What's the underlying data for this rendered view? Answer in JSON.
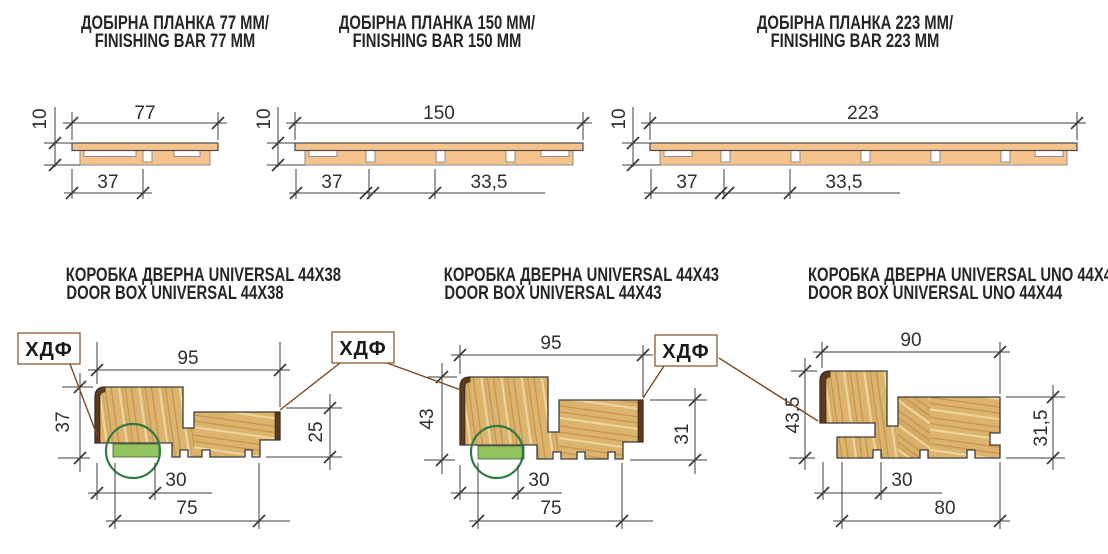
{
  "palette": {
    "bar_peach": "#f6c38d",
    "wood_base": "#dcb46e",
    "wood_grain_dark": "#c3934c",
    "wood_grain_light": "#eed6a0",
    "hdf_brown": "#5b3a1e",
    "seal_green": "#93c45f",
    "highlight_green": "#2e7b45",
    "leader_brown": "#7a4a22",
    "line_color": "#3c3c3c"
  },
  "top_row": [
    {
      "title_line1": "ДОБІРНА ПЛАНКА 77 ММ/",
      "title_line2": "FINISHING BAR 77 MM",
      "dim_width": "77",
      "dim_thickness": "10",
      "dim_seg1": "37"
    },
    {
      "title_line1": "ДОБІРНА ПЛАНКА 150 ММ/",
      "title_line2": "FINISHING BAR 150 MM",
      "dim_width": "150",
      "dim_thickness": "10",
      "dim_seg1": "37",
      "dim_seg2": "33,5"
    },
    {
      "title_line1": "ДОБІРНА ПЛАНКА 223 ММ/",
      "title_line2": "FINISHING BAR 223 MM",
      "dim_width": "223",
      "dim_thickness": "10",
      "dim_seg1": "37",
      "dim_seg2": "33,5"
    }
  ],
  "bottom_row": [
    {
      "title_line1": "КОРОБКА ДВЕРНА UNIVERSAL 44X38",
      "title_line2": "DOOR BOX UNIVERSAL 44X38",
      "dim_top": "95",
      "dim_left": "37",
      "dim_right": "25",
      "dim_groove": "30",
      "dim_bottom": "75"
    },
    {
      "title_line1": "КОРОБКА ДВЕРНА UNIVERSAL 44X43",
      "title_line2": "DOOR BOX UNIVERSAL 44X43",
      "dim_top": "95",
      "dim_left": "43",
      "dim_right": "31",
      "dim_groove": "30",
      "dim_bottom": "75"
    },
    {
      "title_line1": "КОРОБКА ДВЕРНА UNIVERSAL UNO 44X44",
      "title_line2": "DOOR BOX UNIVERSAL UNO 44X44",
      "dim_top": "90",
      "dim_left": "43,5",
      "dim_right": "31,5",
      "dim_groove": "30",
      "dim_bottom": "80"
    }
  ],
  "hdf_boxes": [
    {
      "label": "ХДФ"
    },
    {
      "label": "ХДФ"
    },
    {
      "label": "ХДФ"
    }
  ]
}
